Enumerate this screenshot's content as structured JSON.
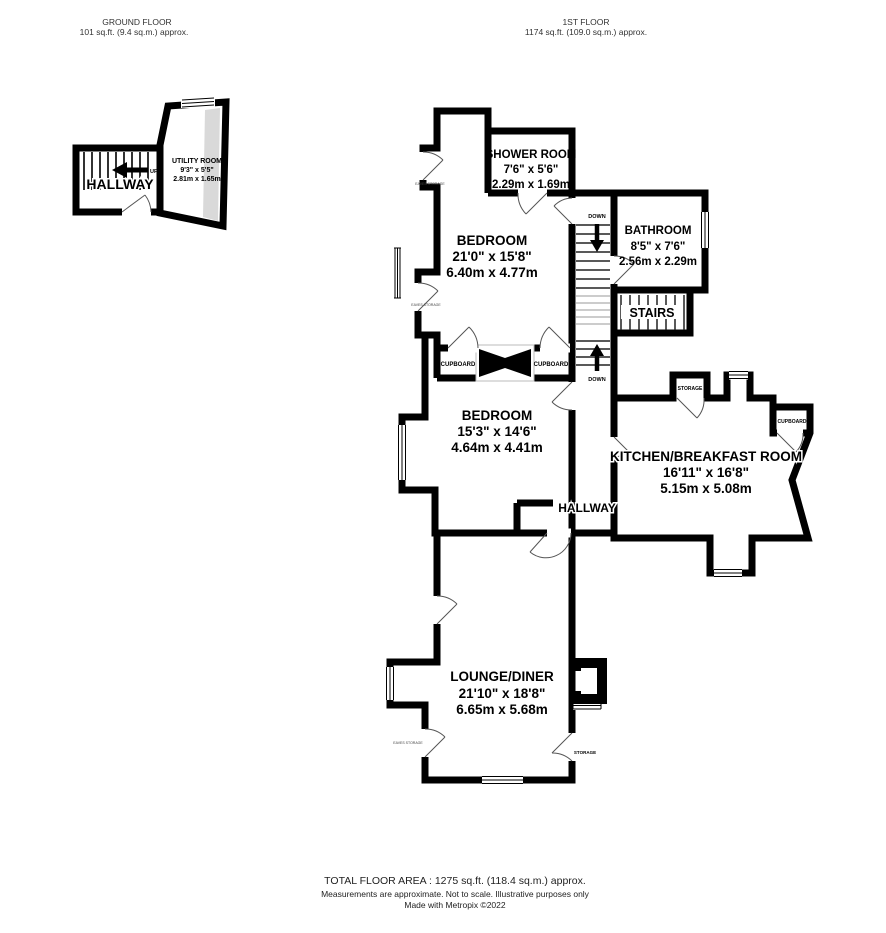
{
  "floors": {
    "ground": {
      "title": "GROUND FLOOR",
      "area": "101 sq.ft. (9.4 sq.m.) approx."
    },
    "first": {
      "title": "1ST FLOOR",
      "area": "1174 sq.ft. (109.0 sq.m.) approx."
    }
  },
  "rooms": {
    "hallway_gf": {
      "name": "HALLWAY"
    },
    "utility": {
      "name": "UTILITY ROOM",
      "dims_ft": "9'3\" x 5'5\"",
      "dims_m": "2.81m x 1.65m"
    },
    "shower": {
      "name": "SHOWER ROOM",
      "dims_ft": "7'6\" x 5'6\"",
      "dims_m": "2.29m x 1.69m"
    },
    "bathroom": {
      "name": "BATHROOM",
      "dims_ft": "8'5\" x 7'6\"",
      "dims_m": "2.56m x 2.29m"
    },
    "stairs": {
      "name": "STAIRS"
    },
    "bedroom1": {
      "name": "BEDROOM",
      "dims_ft": "21'0\" x 15'8\"",
      "dims_m": "6.40m x 4.77m"
    },
    "bedroom2": {
      "name": "BEDROOM",
      "dims_ft": "15'3\" x 14'6\"",
      "dims_m": "4.64m x 4.41m"
    },
    "kitchen": {
      "name": "KITCHEN/BREAKFAST ROOM",
      "dims_ft": "16'11\" x 16'8\"",
      "dims_m": "5.15m x 5.08m"
    },
    "hallway_ff": {
      "name": "HALLWAY"
    },
    "lounge": {
      "name": "LOUNGE/DINER",
      "dims_ft": "21'10\" x 18'8\"",
      "dims_m": "6.65m x 5.68m"
    }
  },
  "closets": {
    "cupboard_left": "CUPBOARD",
    "cupboard_right": "CUPBOARD",
    "storage_kitchen": "STORAGE",
    "cupboard_kitchen": "CUPBOARD",
    "storage_lounge": "STORAGE",
    "eaves": "EAVES STORAGE"
  },
  "stairs_labels": {
    "up": "UP",
    "down_top": "DOWN",
    "down_bottom": "DOWN"
  },
  "footer": {
    "total": "TOTAL FLOOR AREA : 1275 sq.ft. (118.4 sq.m.) approx.",
    "note1": "Measurements are approximate.  Not to scale.  Illustrative purposes only",
    "note2": "Made with Metropix ©2022"
  },
  "colors": {
    "wall": "#000000",
    "eaves_shade": "#d9d9d9",
    "door": "#555555"
  }
}
